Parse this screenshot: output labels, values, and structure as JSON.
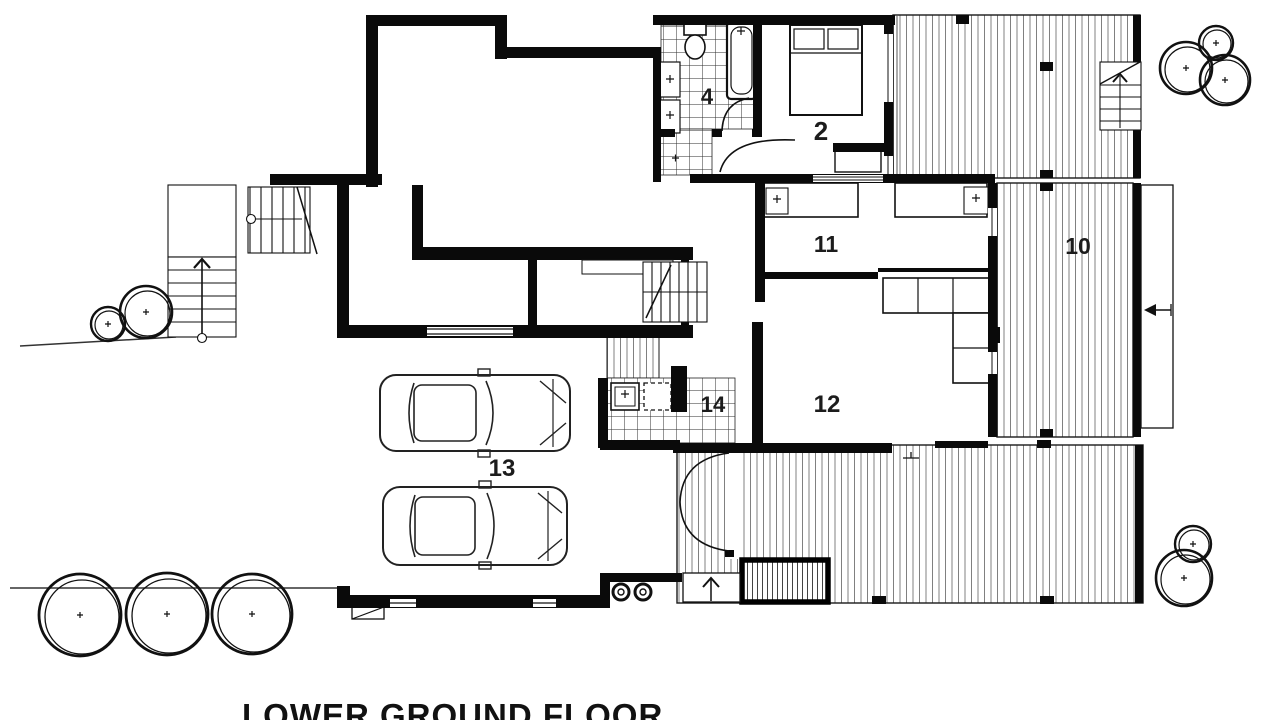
{
  "drawing": {
    "title": "LOWER GROUND FLOOR",
    "type_note": "architectural floor plan",
    "rooms": [
      {
        "number": "4",
        "name": "bathroom"
      },
      {
        "number": "2",
        "name": "bedroom"
      },
      {
        "number": "11",
        "name": "kitchen-dining"
      },
      {
        "number": "10",
        "name": "deck"
      },
      {
        "number": "12",
        "name": "living"
      },
      {
        "number": "14",
        "name": "laundry"
      },
      {
        "number": "13",
        "name": "garage"
      }
    ],
    "colors": {
      "wall": "#0a0a0a",
      "hatch": "#7a7a7a",
      "tile": "#333333",
      "label": "#1c1c1c"
    }
  }
}
